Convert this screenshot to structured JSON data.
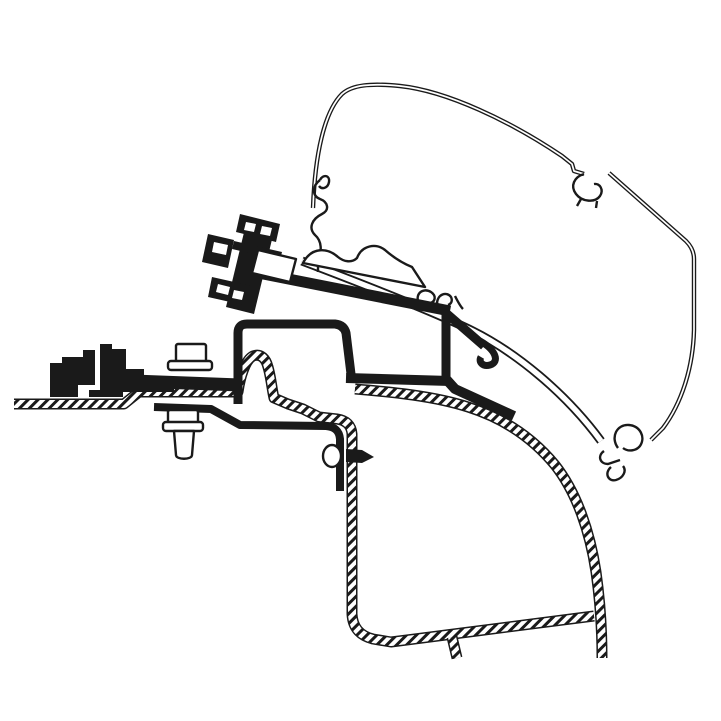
{
  "figure": {
    "kind": "technical-line-drawing",
    "background_color": "#ffffff",
    "ink_color": "#1a1a1a",
    "components": [
      {
        "name": "awning-case-outline"
      },
      {
        "name": "awning-case-top-clip"
      },
      {
        "name": "awning-case-bottom-clip"
      },
      {
        "name": "awning-mounting-rail"
      },
      {
        "name": "rail-seal-profile"
      },
      {
        "name": "adapter-bracket"
      },
      {
        "name": "adapter-clamp-bolts"
      },
      {
        "name": "roof-clamp-bolt-top"
      },
      {
        "name": "roof-clamp-bolt-bottom"
      },
      {
        "name": "wall-fixing-screw"
      },
      {
        "name": "vehicle-roof-panel"
      },
      {
        "name": "roof-rib-profile"
      },
      {
        "name": "vehicle-side-wall"
      },
      {
        "name": "roof-mount-stepped-profile"
      }
    ]
  }
}
